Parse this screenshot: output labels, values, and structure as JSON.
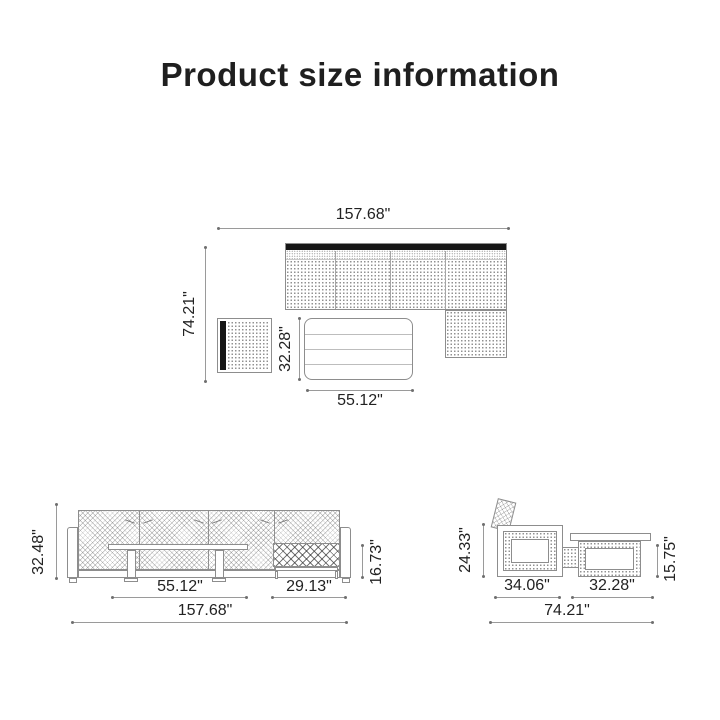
{
  "title": "Product size information",
  "top_view": {
    "overall_width": "157.68\"",
    "overall_depth": "74.21\"",
    "coffee_table_depth": "32.28\"",
    "coffee_table_width": "55.12\""
  },
  "front_view": {
    "sofa_height": "32.48\"",
    "coffee_table_width": "55.12\"",
    "side_table_width": "29.13\"",
    "overall_width": "157.68\"",
    "side_table_height": "16.73\""
  },
  "side_view": {
    "sofa_height": "24.33\"",
    "sofa_depth": "34.06\"",
    "coffee_table_width": "32.28\"",
    "overall_depth": "74.21\"",
    "coffee_table_height": "15.75\""
  },
  "colors": {
    "background": "#ffffff",
    "text": "#1f1f1f",
    "outline": "#8d8d8d",
    "dimension_line": "#9a9a9a",
    "backrest_fill": "#161616"
  }
}
